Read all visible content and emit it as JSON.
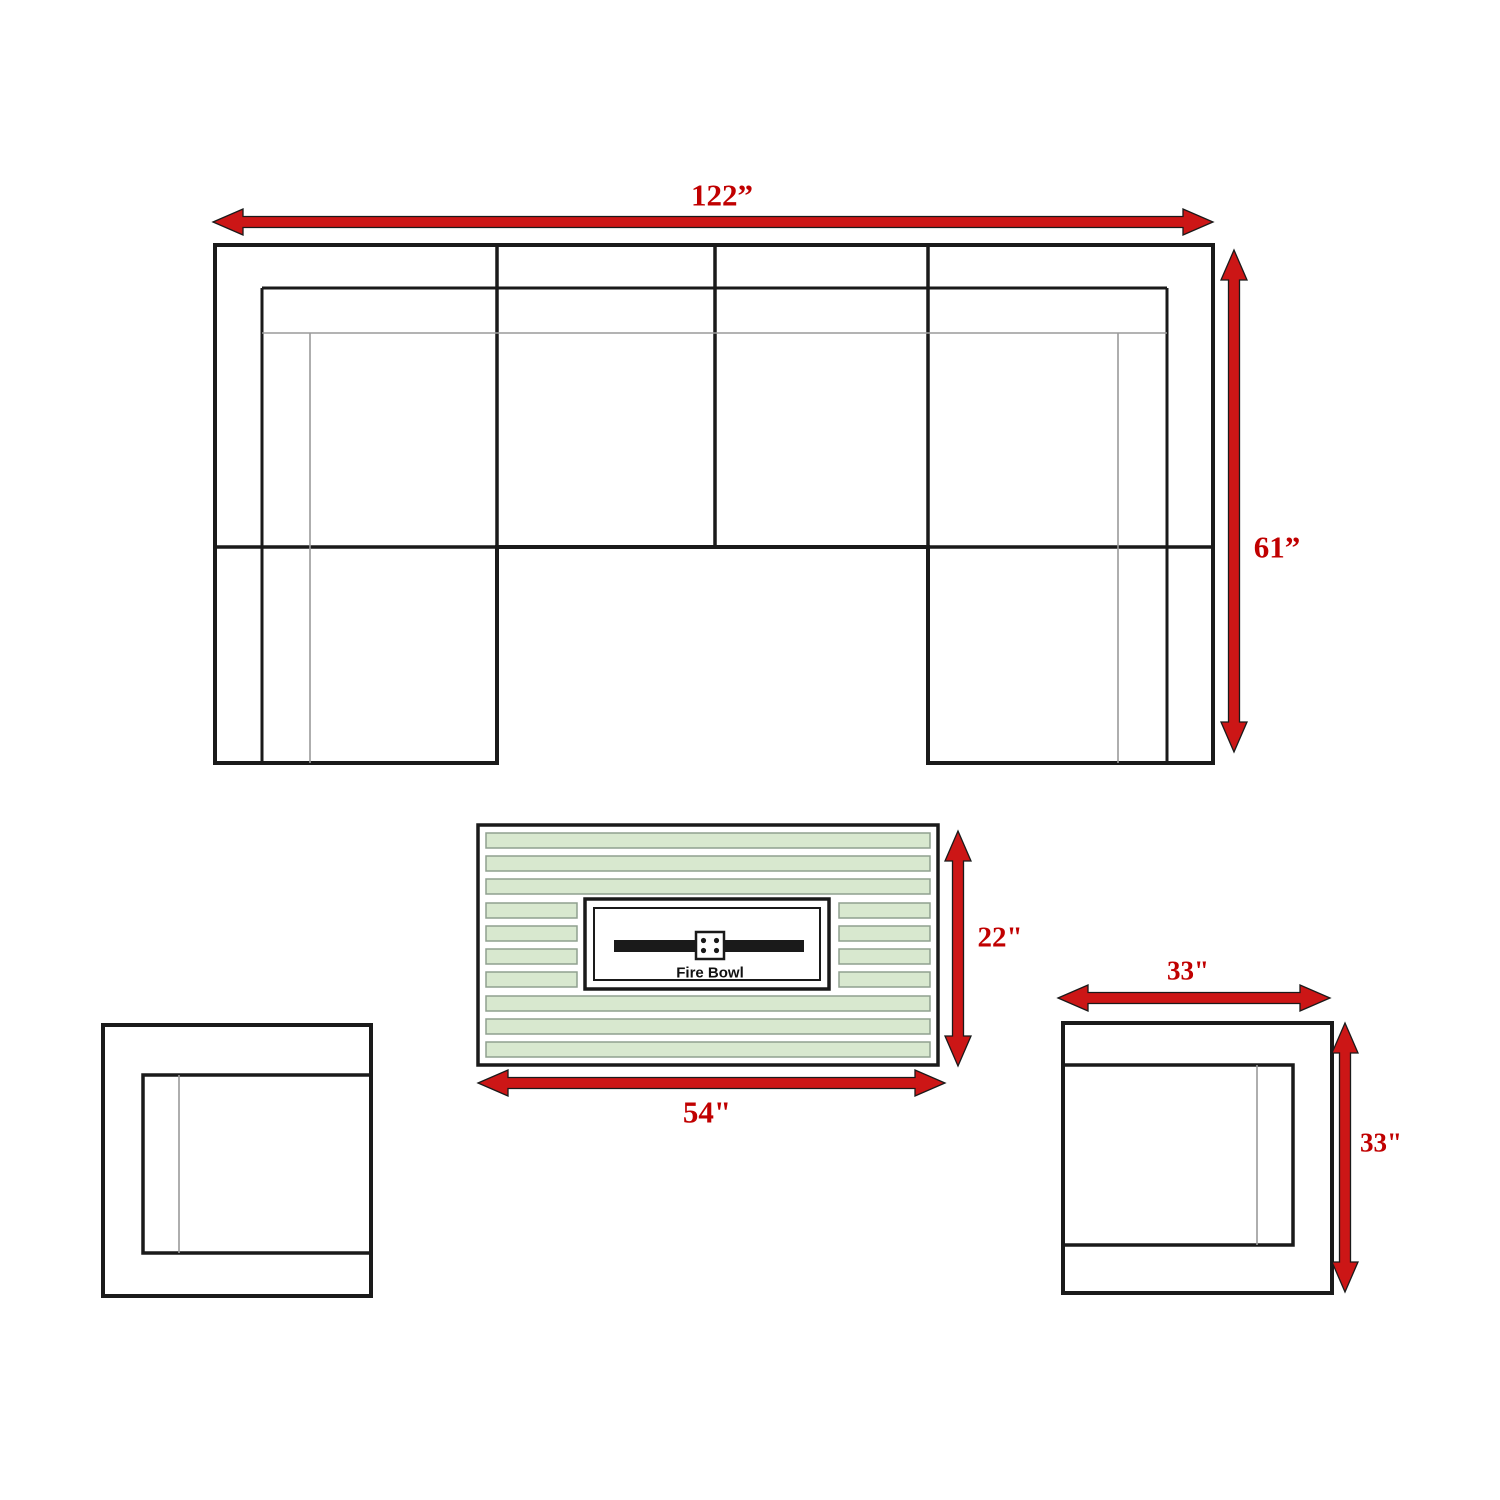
{
  "labels": {
    "sofa_width": "122”",
    "sofa_depth": "61”",
    "fire_table_height": "22\"",
    "fire_table_width": "54\"",
    "chair_width": "33\"",
    "chair_height": "33\"",
    "fire_bowl": "Fire Bowl"
  },
  "colors": {
    "arrow-red": "#cc1616",
    "label-red": "#c00000",
    "slat-green": "#d8e8cf",
    "slat-border": "#8fa08f",
    "line-black": "#1a1a1a",
    "line-gray": "#9a9a9a",
    "bg": "#ffffff"
  }
}
